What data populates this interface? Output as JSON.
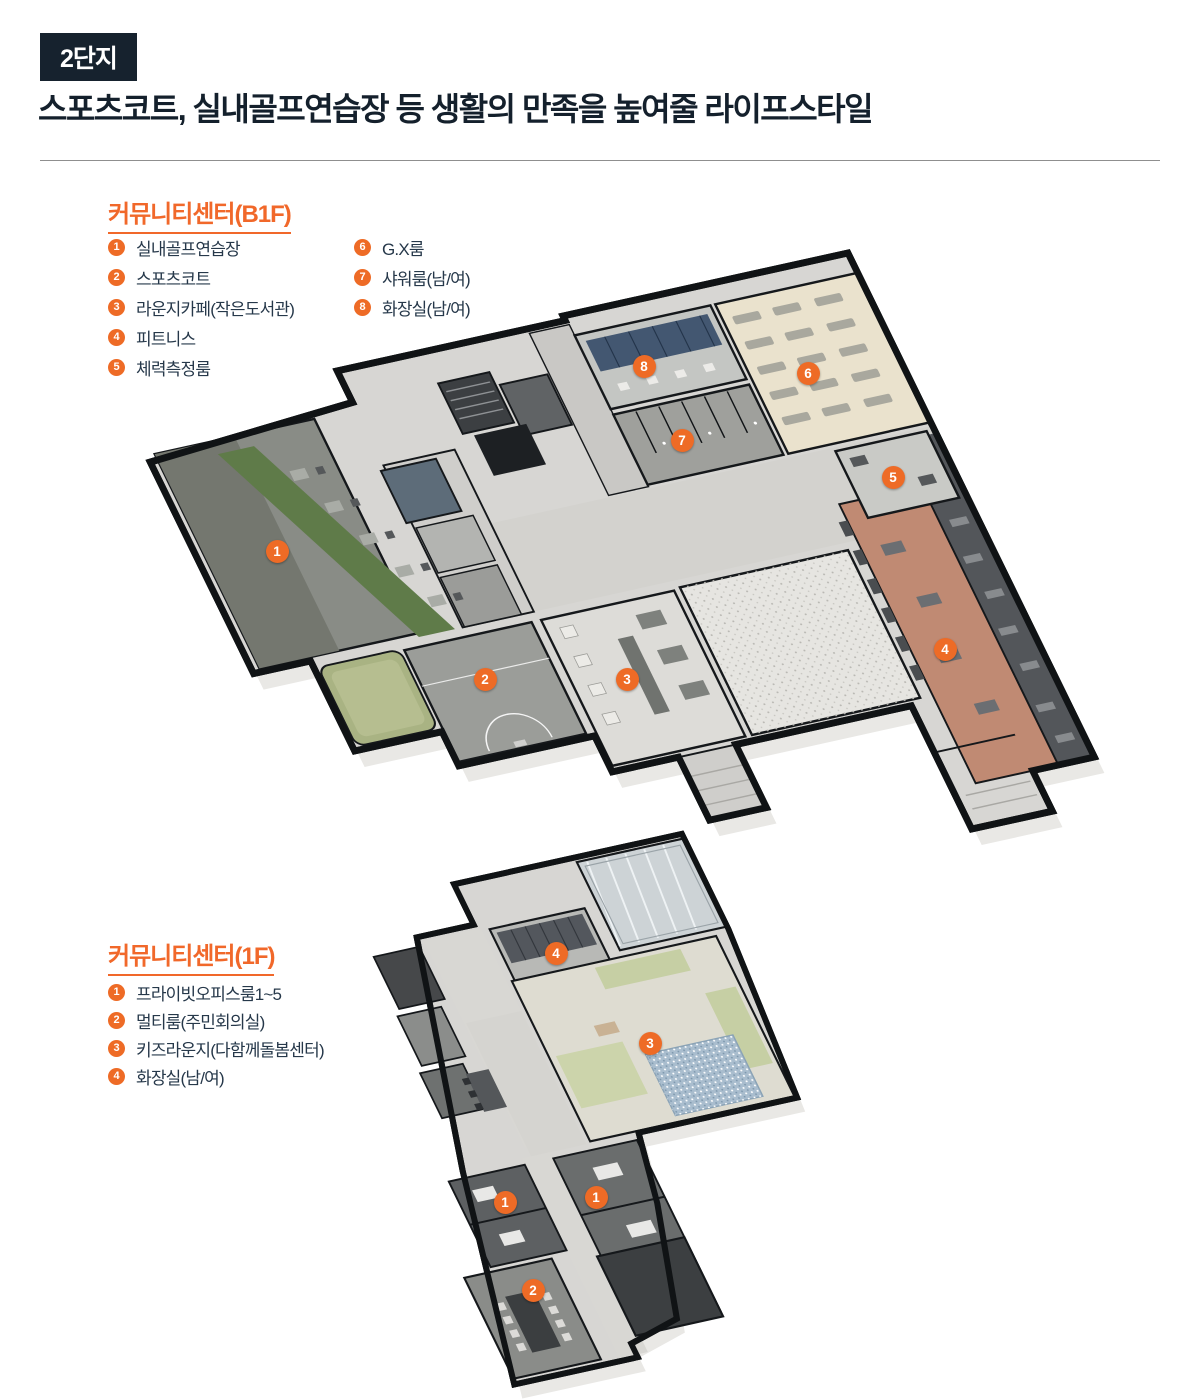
{
  "page": {
    "badge": "2단지",
    "title": "스포츠코트, 실내골프연습장 등 생활의 만족을 높여줄 라이프스타일"
  },
  "colors": {
    "accent_orange": "#ee6b26",
    "heading_orange": "#f1682a",
    "navy_text": "#14202c",
    "legend_text": "#26384a",
    "badge_bg": "#16222e"
  },
  "b1f": {
    "heading": "커뮤니티센터(B1F)",
    "legend_col1": [
      {
        "n": "1",
        "label": "실내골프연습장"
      },
      {
        "n": "2",
        "label": "스포츠코트"
      },
      {
        "n": "3",
        "label": "라운지카페(작은도서관)"
      },
      {
        "n": "4",
        "label": "피트니스"
      },
      {
        "n": "5",
        "label": "체력측정룸"
      }
    ],
    "legend_col2": [
      {
        "n": "6",
        "label": "G.X룸"
      },
      {
        "n": "7",
        "label": "샤워룸(남/여)"
      },
      {
        "n": "8",
        "label": "화장실(남/여)"
      }
    ],
    "markers": [
      {
        "n": "1",
        "x": 277,
        "y": 551
      },
      {
        "n": "2",
        "x": 485,
        "y": 679
      },
      {
        "n": "3",
        "x": 627,
        "y": 679
      },
      {
        "n": "4",
        "x": 945,
        "y": 649
      },
      {
        "n": "5",
        "x": 893,
        "y": 477
      },
      {
        "n": "6",
        "x": 808,
        "y": 373
      },
      {
        "n": "7",
        "x": 682,
        "y": 440
      },
      {
        "n": "8",
        "x": 644,
        "y": 366
      }
    ]
  },
  "f1": {
    "heading": "커뮤니티센터(1F)",
    "legend": [
      {
        "n": "1",
        "label": "프라이빗오피스룸1~5"
      },
      {
        "n": "2",
        "label": "멀티룸(주민회의실)"
      },
      {
        "n": "3",
        "label": "키즈라운지(다함께돌봄센터)"
      },
      {
        "n": "4",
        "label": "화장실(남/여)"
      }
    ],
    "markers": [
      {
        "n": "4",
        "x": 556,
        "y": 953
      },
      {
        "n": "3",
        "x": 650,
        "y": 1043
      },
      {
        "n": "1",
        "x": 505,
        "y": 1202
      },
      {
        "n": "1",
        "x": 596,
        "y": 1197
      },
      {
        "n": "2",
        "x": 533,
        "y": 1290
      }
    ]
  }
}
